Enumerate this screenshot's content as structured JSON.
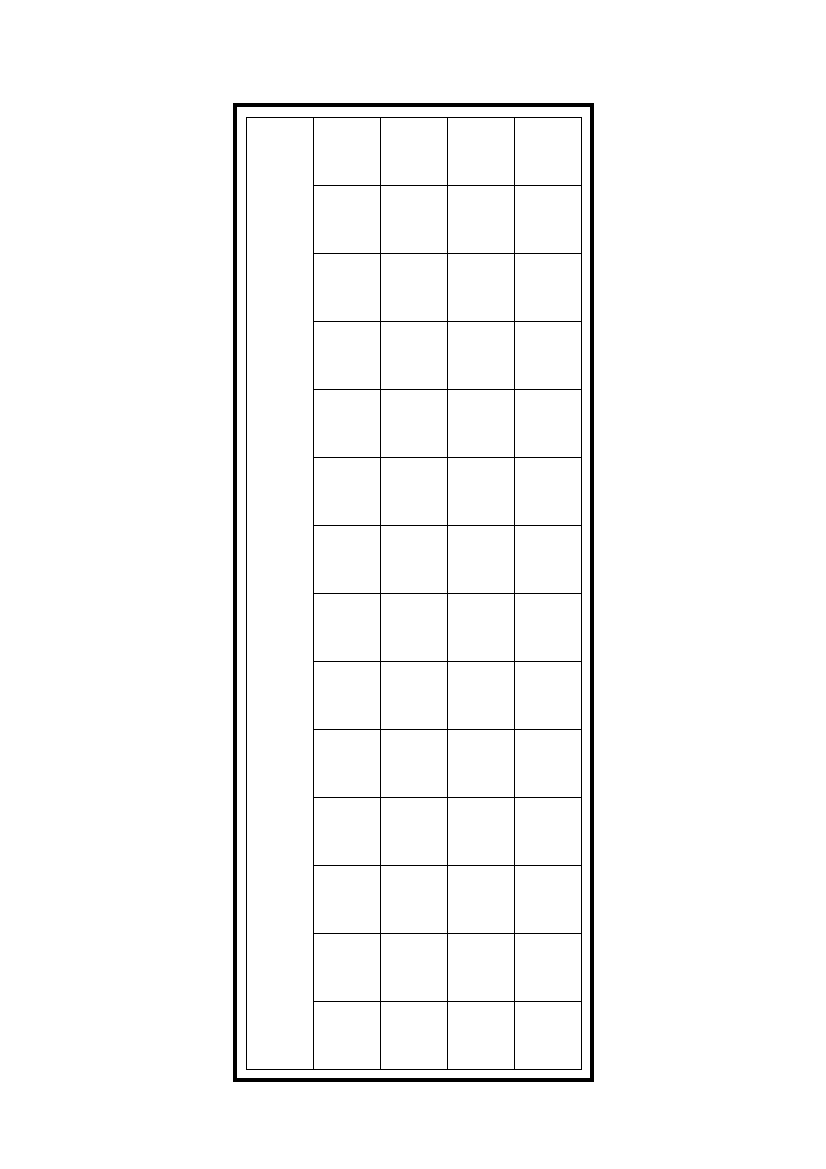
{
  "document": {
    "background_color": "#ffffff"
  },
  "frame": {
    "border_color": "#000000",
    "border_width_px": 4,
    "left_px": 233,
    "top_px": 103,
    "width_px": 361,
    "height_px": 979
  },
  "grid": {
    "line_color": "#000000",
    "line_width_px": 1,
    "columns_total": 5,
    "writing_columns": 4,
    "rows": 14,
    "first_column_merged_full_height": true,
    "cell_width_px": 66,
    "cell_height_px": 67,
    "offset_in_frame_left_px": 9,
    "offset_in_frame_top_px": 10,
    "all_cells_empty": true
  }
}
